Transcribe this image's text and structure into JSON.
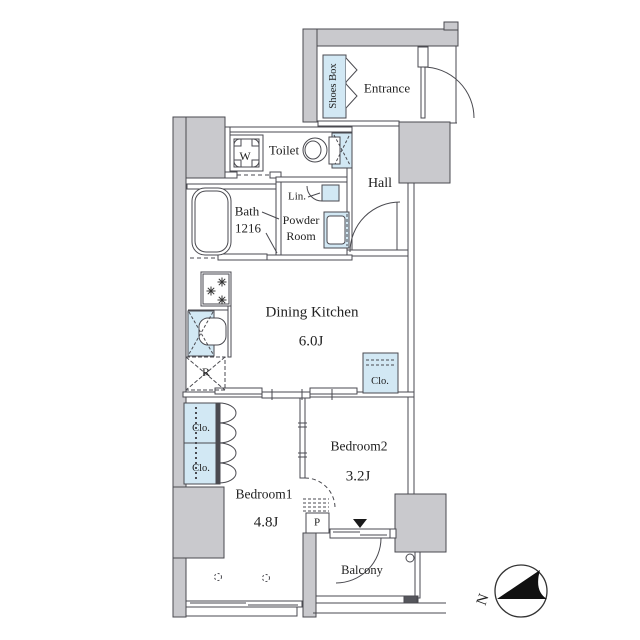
{
  "type": "apartment-floor-plan",
  "colors": {
    "wall_fill": "#c9c9cd",
    "line": "#4a4a50",
    "fixture_blue": "#d2e8f4",
    "text": "#222222"
  },
  "rooms": {
    "entrance": {
      "label": "Entrance"
    },
    "shoes_box": {
      "label": "Shoes Box"
    },
    "toilet": {
      "label": "Toilet"
    },
    "washer": {
      "label": "W"
    },
    "hall": {
      "label": "Hall"
    },
    "bath": {
      "label": "Bath",
      "size": "1216"
    },
    "linen": {
      "label": "Lin."
    },
    "powder_room": {
      "label_line1": "Powder",
      "label_line2": "Room"
    },
    "dining_kitchen": {
      "label": "Dining Kitchen",
      "size": "6.0J"
    },
    "refrigerator": {
      "label": "R"
    },
    "closet_dining": {
      "label": "Clo."
    },
    "bedroom1": {
      "label": "Bedroom1",
      "size": "4.8J"
    },
    "closet1_upper": {
      "label": "Clo."
    },
    "closet1_lower": {
      "label": "Clo."
    },
    "bedroom2": {
      "label": "Bedroom2",
      "size": "3.2J"
    },
    "pipe_space": {
      "label": "P"
    },
    "balcony": {
      "label": "Balcony"
    },
    "compass": {
      "label": "N"
    }
  }
}
